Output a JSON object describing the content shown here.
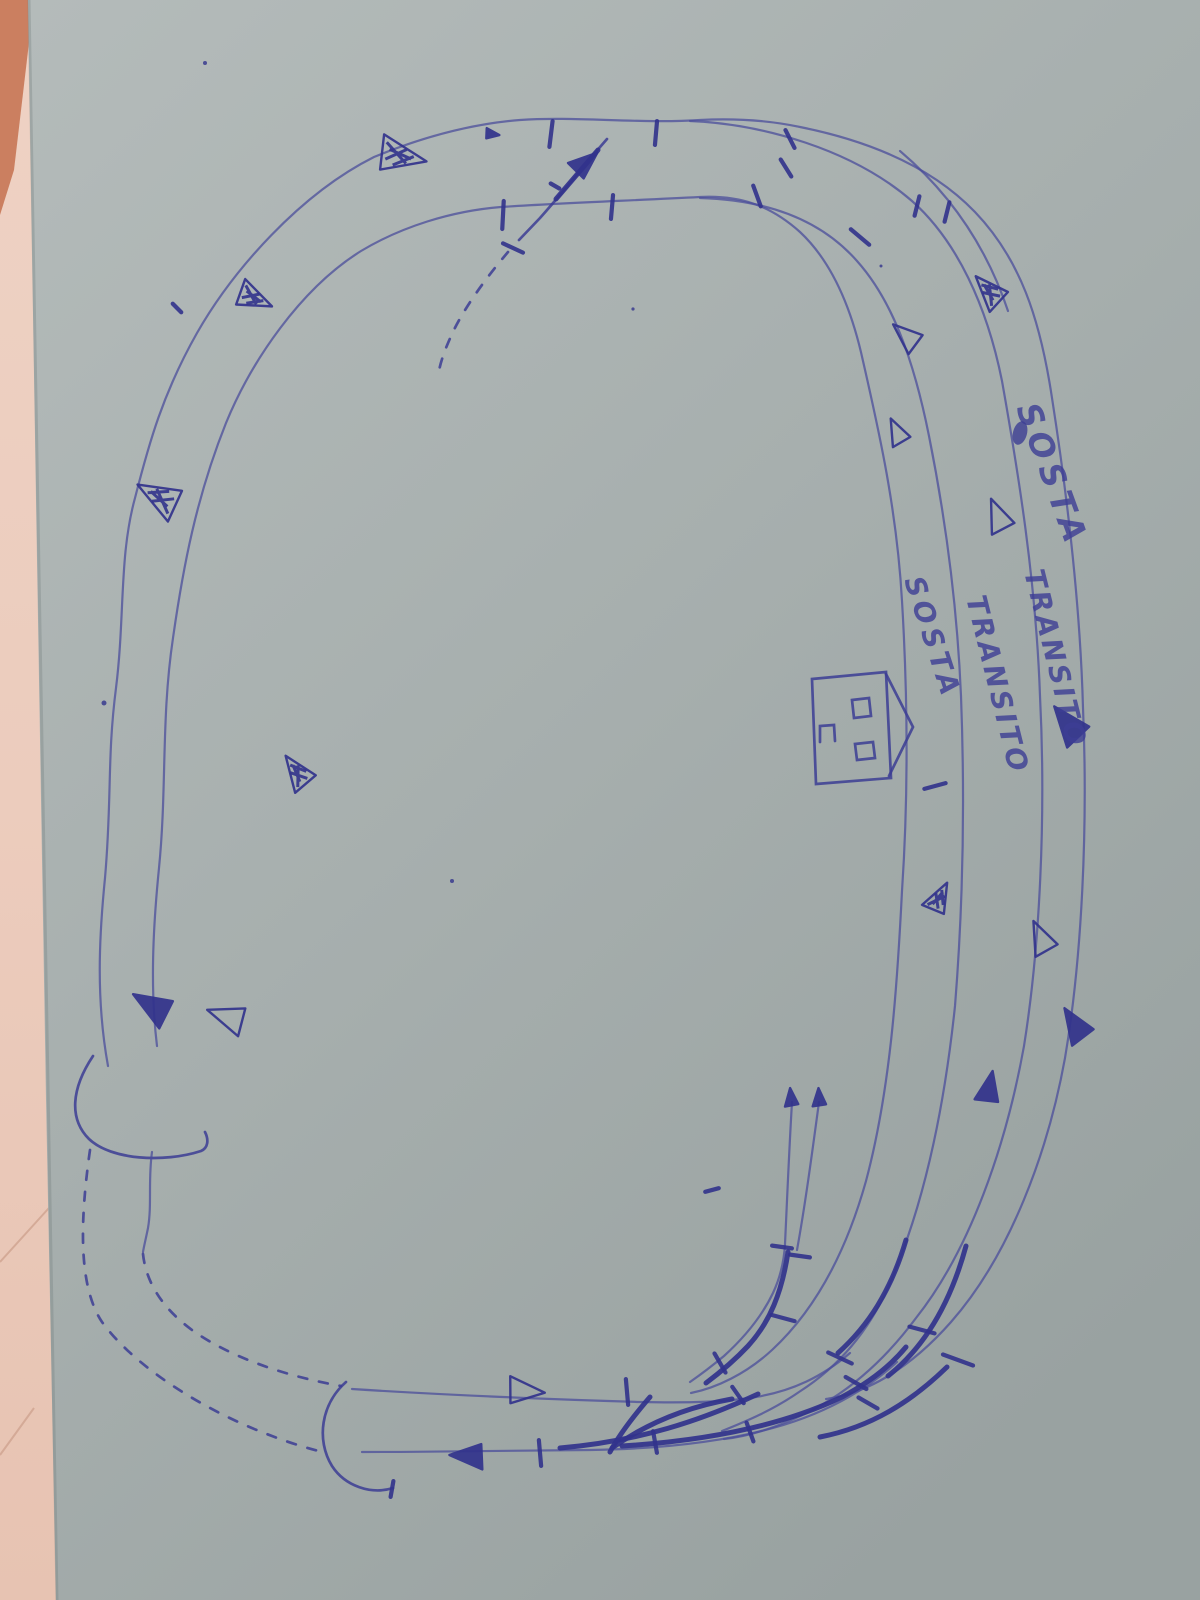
{
  "palette": {
    "pen": "#3c3d94",
    "pen_dark": "#32338c",
    "pen_faded": "#4b4e9b",
    "paper_top": "#b3bab9",
    "paper_mid": "#a7afae",
    "paper_bottom": "#99a2a1",
    "surface_pink": "#ecccbd",
    "surface_pink_deep": "#e2b5a1",
    "surface_red_corner": "#c4714f",
    "crack": "#d2a694"
  },
  "labels": [
    {
      "id": "sosta-outer",
      "text": "SOSTA"
    },
    {
      "id": "transito-outer",
      "text": "TRANSITO"
    },
    {
      "id": "transito-inner",
      "text": "TRANSITO"
    },
    {
      "id": "sosta-inner",
      "text": "SOSTA"
    }
  ],
  "icons": {
    "station_house": "house-icon",
    "direction_marker": "arrow-icon",
    "tunnel_portal": "portal-arc",
    "section_break": "tick-mark"
  },
  "marks": {
    "arrows": [
      {
        "x": 401,
        "y": 156,
        "rot": 12,
        "style": "scribble",
        "size": 42
      },
      {
        "x": 254,
        "y": 298,
        "rot": 25,
        "style": "scribble",
        "size": 32
      },
      {
        "x": 159,
        "y": 497,
        "rot": 210,
        "style": "scribble",
        "size": 40
      },
      {
        "x": 297,
        "y": 772,
        "rot": 235,
        "style": "scribble",
        "size": 32
      },
      {
        "x": 152,
        "y": 1006,
        "rot": 212,
        "style": "filled",
        "size": 36
      },
      {
        "x": 227,
        "y": 1017,
        "rot": 200,
        "style": "outline",
        "size": 34
      },
      {
        "x": 585,
        "y": 163,
        "rot": -40,
        "style": "filled",
        "size": 26
      },
      {
        "x": 492,
        "y": 134,
        "rot": 8,
        "style": "filled",
        "size": 12
      },
      {
        "x": 989,
        "y": 291,
        "rot": 228,
        "style": "scribble",
        "size": 32
      },
      {
        "x": 906,
        "y": 336,
        "rot": 222,
        "style": "outline",
        "size": 28
      },
      {
        "x": 897,
        "y": 432,
        "rot": 245,
        "style": "outline",
        "size": 24
      },
      {
        "x": 998,
        "y": 516,
        "rot": 248,
        "style": "outline",
        "size": 30
      },
      {
        "x": 1068,
        "y": 724,
        "rot": 232,
        "style": "filled",
        "size": 36
      },
      {
        "x": 939,
        "y": 898,
        "rot": -62,
        "style": "scribble",
        "size": 28
      },
      {
        "x": 1041,
        "y": 938,
        "rot": 246,
        "style": "outline",
        "size": 30
      },
      {
        "x": 1075,
        "y": 1025,
        "rot": 238,
        "style": "filled",
        "size": 32
      },
      {
        "x": 989,
        "y": 1088,
        "rot": -78,
        "style": "filled",
        "size": 28
      },
      {
        "x": 791,
        "y": 1098,
        "rot": -95,
        "style": "filled",
        "size": 16
      },
      {
        "x": 819,
        "y": 1098,
        "rot": -93,
        "style": "filled",
        "size": 16
      },
      {
        "x": 525,
        "y": 1391,
        "rot": 5,
        "style": "outline",
        "size": 32
      },
      {
        "x": 468,
        "y": 1456,
        "rot": 183,
        "style": "filled",
        "size": 30
      }
    ],
    "ticks": [
      [
        551,
        134,
        97,
        26
      ],
      [
        656,
        133,
        95,
        24
      ],
      [
        503,
        215,
        93,
        28
      ],
      [
        612,
        207,
        95,
        24
      ],
      [
        513,
        248,
        25,
        22
      ],
      [
        757,
        196,
        70,
        22
      ],
      [
        786,
        168,
        58,
        20
      ],
      [
        790,
        139,
        63,
        20
      ],
      [
        860,
        237,
        40,
        24
      ],
      [
        917,
        206,
        104,
        20
      ],
      [
        947,
        212,
        104,
        20
      ],
      [
        935,
        786,
        -15,
        22
      ],
      [
        782,
        1247,
        8,
        20
      ],
      [
        800,
        1256,
        8,
        20
      ],
      [
        720,
        1363,
        60,
        22
      ],
      [
        738,
        1395,
        55,
        20
      ],
      [
        783,
        1318,
        15,
        24
      ],
      [
        840,
        1358,
        25,
        26
      ],
      [
        856,
        1383,
        30,
        24
      ],
      [
        868,
        1403,
        30,
        22
      ],
      [
        922,
        1330,
        15,
        26
      ],
      [
        958,
        1360,
        20,
        32
      ],
      [
        750,
        1432,
        70,
        20
      ],
      [
        655,
        1442,
        80,
        22
      ],
      [
        540,
        1453,
        85,
        26
      ],
      [
        627,
        1392,
        85,
        26
      ],
      [
        392,
        1489,
        100,
        16
      ],
      [
        712,
        1190,
        -15,
        14
      ],
      [
        555,
        186,
        30,
        10
      ],
      [
        177,
        308,
        45,
        12
      ]
    ],
    "dots": [
      [
        205,
        63,
        2
      ],
      [
        104,
        703,
        2.5
      ],
      [
        452,
        881,
        2
      ],
      [
        633,
        309,
        1.6
      ],
      [
        881,
        266,
        1.5
      ]
    ]
  }
}
